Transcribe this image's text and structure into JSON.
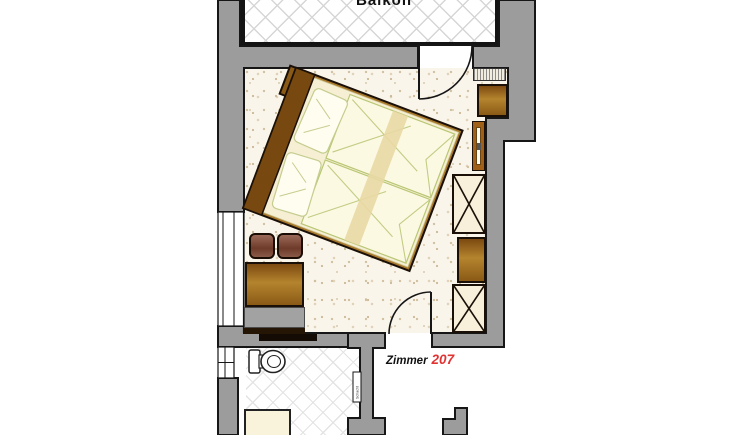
{
  "labels": {
    "balcony": "Balkon",
    "room_word": "Zimmer",
    "room_number": "207",
    "shaft": "Schacht"
  },
  "colors": {
    "wall_fill": "#9c9c9c",
    "wall_outline": "#161616",
    "room_number_red": "#e23333",
    "wood": "#a8772a",
    "wood_dark": "#77480f",
    "bed_linen": "#fcf9e3",
    "bed_linen_outline": "#b9c775",
    "wardrobe_fill": "#f8f0da",
    "upholstery": "#744031",
    "floor_base": "#faf5eb",
    "tile_line": "#e3e3e3"
  },
  "furniture": [
    "double-bed",
    "nightstand",
    "stool",
    "stool",
    "table",
    "sideboard",
    "sliding-door",
    "radiator",
    "minibar-cabinet",
    "tv-panel",
    "wardrobe",
    "dresser",
    "wardrobe",
    "toilet",
    "shower"
  ]
}
